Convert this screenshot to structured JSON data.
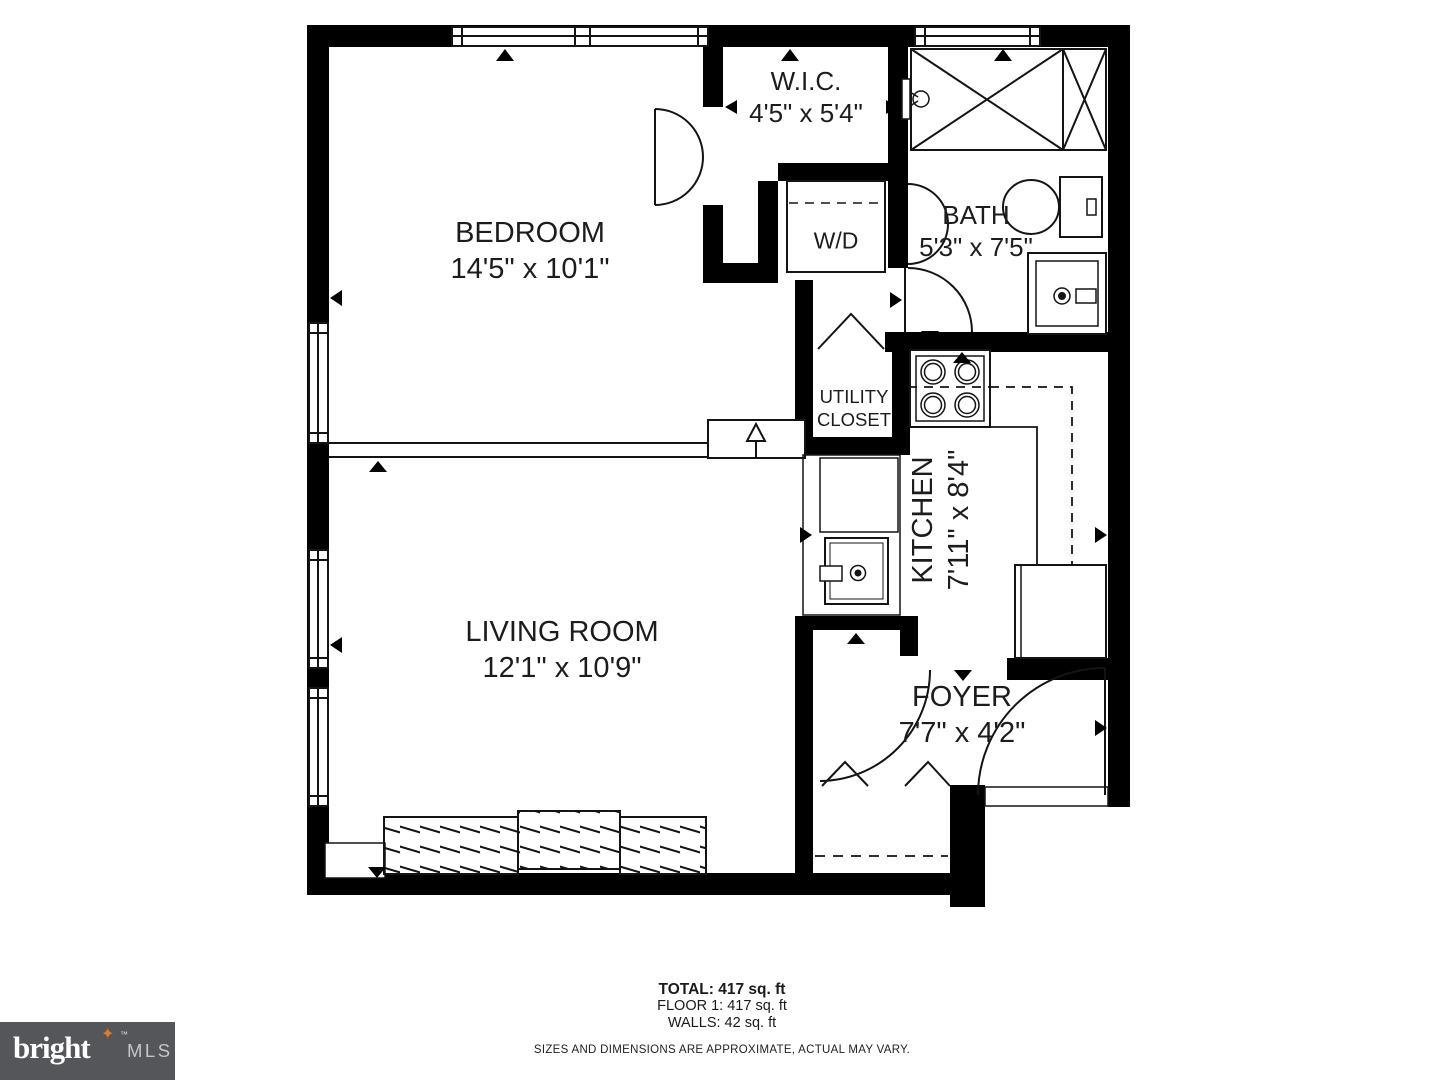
{
  "rooms": {
    "bedroom": {
      "name": "BEDROOM",
      "dims": "14'5\" x 10'1\""
    },
    "wic": {
      "name": "W.I.C.",
      "dims": "4'5\" x 5'4\""
    },
    "bath": {
      "name": "BATH",
      "dims": "5'3\" x 7'5\""
    },
    "washer_dryer": {
      "name": "W/D"
    },
    "utility": {
      "line1": "UTILITY",
      "line2": "CLOSET"
    },
    "kitchen": {
      "name": "KITCHEN",
      "dims": "7'11\" x 8'4\""
    },
    "living": {
      "name": "LIVING ROOM",
      "dims": "12'1\" x 10'9\""
    },
    "foyer": {
      "name": "FOYER",
      "dims": "7'7\" x 4'2\""
    }
  },
  "summary": {
    "total": "TOTAL: 417 sq. ft",
    "floor": "FLOOR 1: 417 sq. ft",
    "walls": "WALLS: 42 sq. ft"
  },
  "disclaimer": "SIZES AND DIMENSIONS ARE APPROXIMATE, ACTUAL MAY VARY.",
  "logo": {
    "brand": "bright",
    "tm": "™",
    "star": "✦",
    "suffix": "MLS",
    "bg_color": "#55565A",
    "star_color": "#E87722",
    "brand_color": "#FFFFFF",
    "suffix_color": "#C4C6C8"
  },
  "colors": {
    "walls": "#000000",
    "lines": "#141414",
    "background": "#FFFFFF"
  }
}
